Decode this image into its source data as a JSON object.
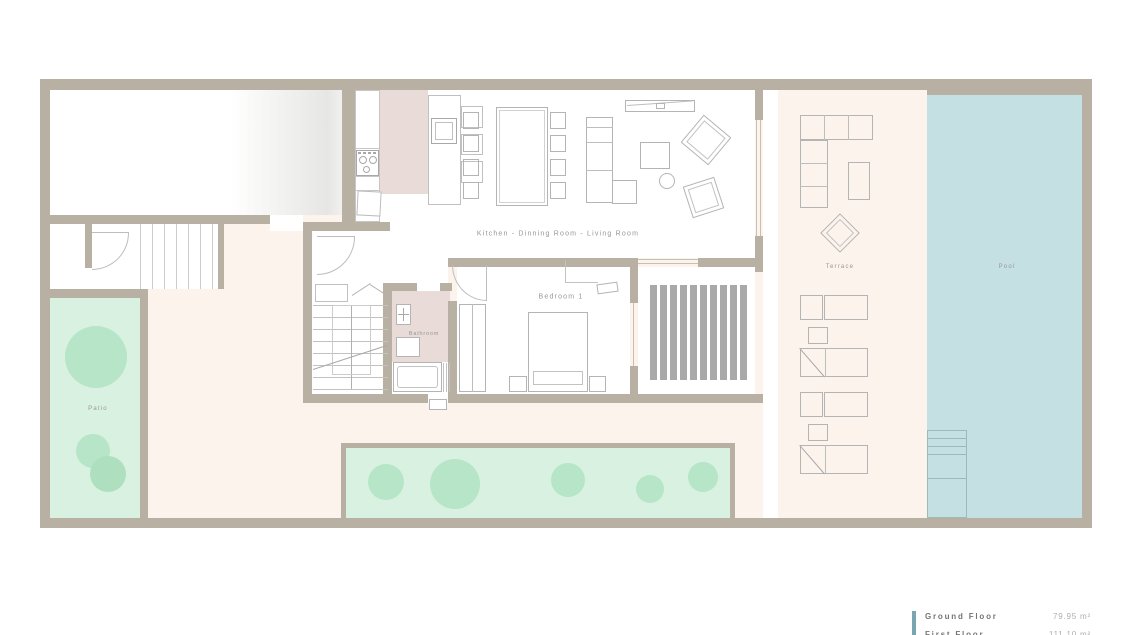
{
  "plan": {
    "rooms": {
      "kitchen_living": "Kitchen - Dinning Room - Living Room",
      "bedroom": "Bedroom 1",
      "bathroom": "Bathroom",
      "patio": "Patio",
      "terrace": "Terrace",
      "pool": "Pool"
    },
    "legend": {
      "rows": [
        {
          "label": "Ground Floor",
          "area": "79.95 m²"
        },
        {
          "label": "First Floor",
          "area": "111.10 m²"
        }
      ]
    },
    "colors": {
      "wall": "#b8b1a3",
      "courtyard": "#fcf3ec",
      "pool_water": "#c5e0e2",
      "lawn": "#d9f1e1",
      "tree": "#b7e5c7",
      "tile_pink": "#e9dcd8",
      "pergola_stripe": "#a9a9a9",
      "legend_accent": "#7aa6b1"
    }
  }
}
